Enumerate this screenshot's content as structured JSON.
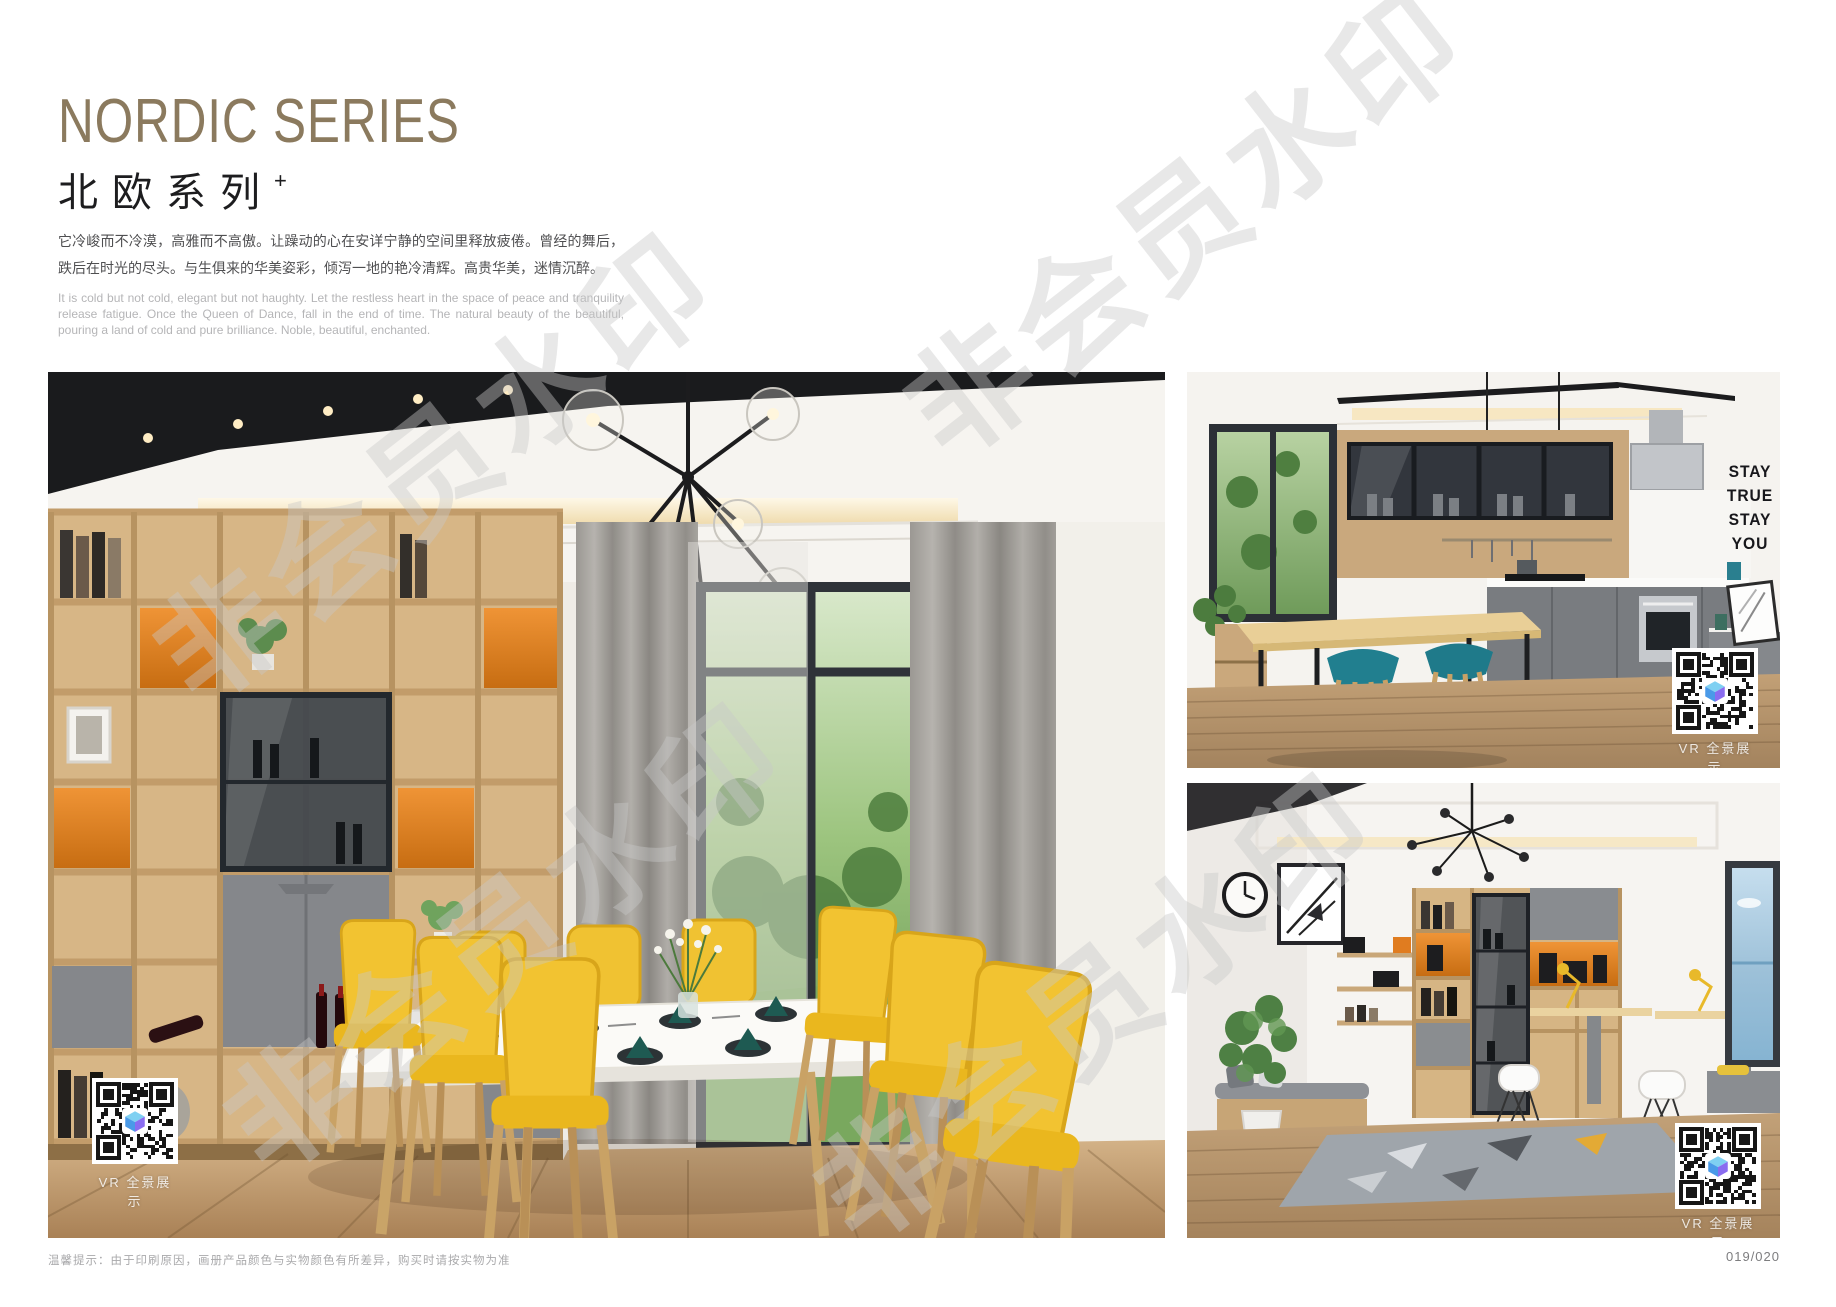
{
  "header": {
    "title_en": "NORDIC SERIES",
    "title_cn": "北欧系列",
    "title_sup": "+",
    "desc_cn": "它冷峻而不冷漠，高雅而不高傲。让躁动的心在安详宁静的空间里释放疲倦。曾经的舞后，跌后在时光的尽头。与生俱来的华美姿彩，倾泻一地的艳冷清辉。高贵华美，迷情沉醉。",
    "desc_en": "It is cold but not cold, elegant but not haughty. Let the restless heart in the space of peace and tranquility release fatigue. Once the Queen of Dance, fall in the end of time. The natural beauty of the beautiful, pouring a land of cold and pure brilliance. Noble, beautiful, enchanted."
  },
  "watermark": {
    "text": "非会员水印"
  },
  "photos": {
    "dining": {
      "vr_label": "VR 全景展示"
    },
    "kitchen": {
      "vr_label": "VR 全景展示",
      "wall_decal": [
        "STAY",
        "TRUE",
        "STAY",
        "YOU"
      ]
    },
    "study": {
      "vr_label": "VR 全景展示"
    }
  },
  "footer": {
    "note": "温馨提示：由于印刷原因，画册产品颜色与实物颜色有所差异，购买时请按实物为准",
    "page_number": "019/020"
  },
  "colors": {
    "title_brown": "#8b7a5e",
    "accent_orange": "#e0801f",
    "chair_yellow": "#f2c331",
    "stool_teal": "#217f8f",
    "cabinet_gray": "#85878b",
    "wood": "#d7b686"
  }
}
